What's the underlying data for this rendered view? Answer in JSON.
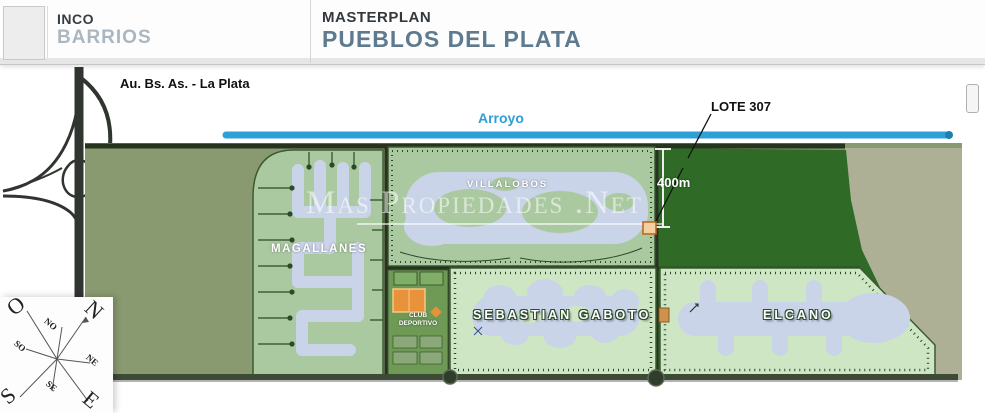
{
  "header": {
    "brand": {
      "line1": "INCO",
      "line2": "BARRIOS"
    },
    "title": {
      "line1": "MASTERPLAN",
      "line2": "PUEBLOS DEL PLATA"
    }
  },
  "annotations": {
    "highway": "Au. Bs. As. - La Plata",
    "arroyo": "Arroyo",
    "lot": "LOTE 307",
    "distance": "400m",
    "watermark": "Mas Propiedades .Net"
  },
  "neighborhoods": {
    "villalobos": "VILLALOBOS",
    "magallanes": "MAGALLANES",
    "gaboto": "SEBASTIAN GABOTO",
    "elcano": "ELCANO",
    "club_line1": "CLUB",
    "club_line2": "DEPORTIVO"
  },
  "compass": {
    "o": "O",
    "n": "N",
    "s": "S",
    "e": "E",
    "no": "NO",
    "so": "SO",
    "ne": "NE",
    "se": "SE"
  },
  "colors": {
    "arroyo_blue": "#2da0d8",
    "title_accent": "#5d7a8e",
    "brand_accent": "#aab7c0",
    "field_olive": "#8a9a70",
    "field_dark_green": "#2f6b27",
    "neighborhood_green": "#abc9a0",
    "lagoon_blue": "#c9d4e8",
    "tan_outside": "#aeb096",
    "club_orange": "#e8923a",
    "lot_marker": "#f5cfa0"
  }
}
